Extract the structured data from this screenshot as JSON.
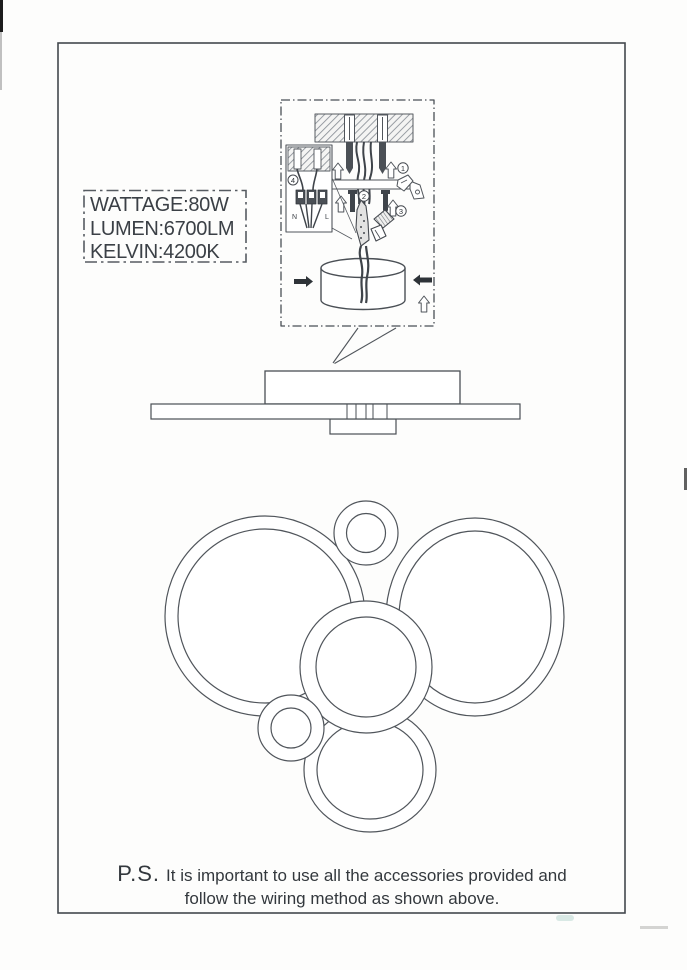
{
  "colors": {
    "line": "#50555b",
    "frame": "#43484e",
    "text": "#3b4046",
    "hatch": "#898f96",
    "dark_metal": "#3f444a",
    "artifact_teal": "#bcd8d2"
  },
  "spec_box": {
    "lines": [
      "WATTAGE:80W",
      "LUMEN:6700LM",
      "KELVIN:4200K"
    ]
  },
  "wiring_inset": {
    "step_labels": [
      "1",
      "2",
      "3",
      "4"
    ],
    "terminal_left": "N",
    "terminal_right": "L"
  },
  "note": {
    "prefix": "P.S.",
    "line1": "It is important to use all the accessories provided and",
    "line2": "follow the wiring method as shown above."
  },
  "diagram": {
    "rings": [
      {
        "name": "ring-right-large",
        "cx": 475,
        "cy": 617,
        "rox": 89,
        "roy": 99,
        "rix": 76,
        "riy": 86
      },
      {
        "name": "ring-left-large",
        "cx": 265,
        "cy": 616,
        "rox": 100,
        "roy": 100,
        "rix": 87,
        "riy": 87
      },
      {
        "name": "ring-bottom",
        "cx": 370,
        "cy": 770,
        "rox": 66,
        "roy": 62,
        "rix": 53,
        "riy": 49
      },
      {
        "name": "ring-center",
        "cx": 366,
        "cy": 667,
        "rox": 66,
        "roy": 66,
        "rix": 50,
        "riy": 50
      },
      {
        "name": "ring-top-small",
        "cx": 366,
        "cy": 533,
        "rox": 32,
        "roy": 32,
        "rix": 19.5,
        "riy": 19.5
      },
      {
        "name": "ring-left-small",
        "cx": 291,
        "cy": 728,
        "rox": 33,
        "roy": 33,
        "rix": 20,
        "riy": 20
      }
    ]
  }
}
